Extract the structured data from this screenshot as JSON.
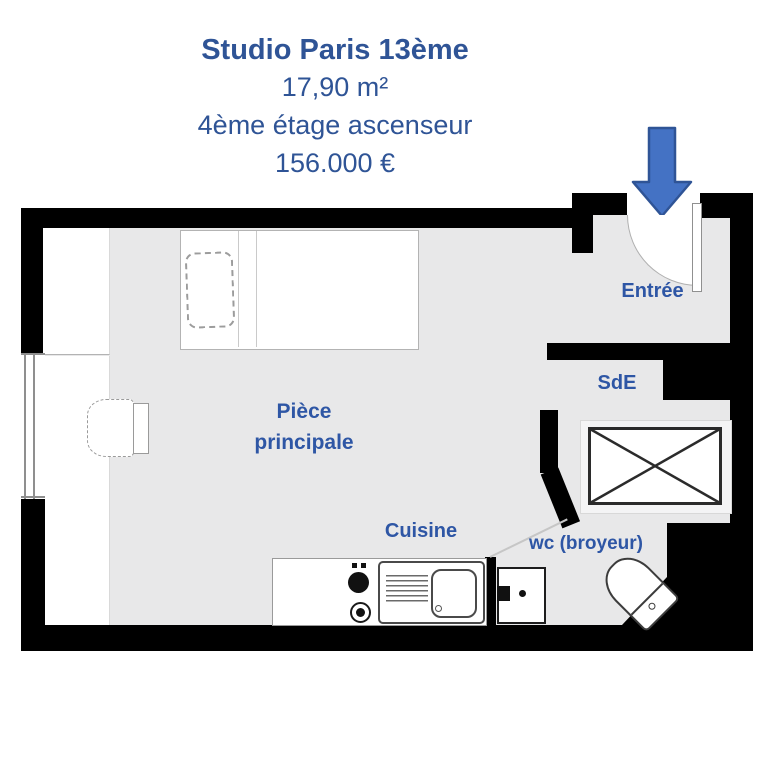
{
  "header": {
    "title": "Studio Paris 13ème",
    "area": "17,90 m²",
    "floor": "4ème étage ascenseur",
    "price": "156.000 €"
  },
  "rooms": {
    "entree": "Entrée",
    "sde": "SdE",
    "main": "Pièce principale",
    "cuisine": "Cuisine",
    "wc": "wc (broyeur)"
  },
  "icons": {
    "entrance_arrow": "arrow-down"
  },
  "colors": {
    "title_blue": "#2F5496",
    "label_blue": "#2E56A5",
    "arrow_fill": "#4472C4",
    "arrow_stroke": "#2F5496",
    "wall_black": "#000000",
    "floor_gray": "#E8E8E9"
  }
}
